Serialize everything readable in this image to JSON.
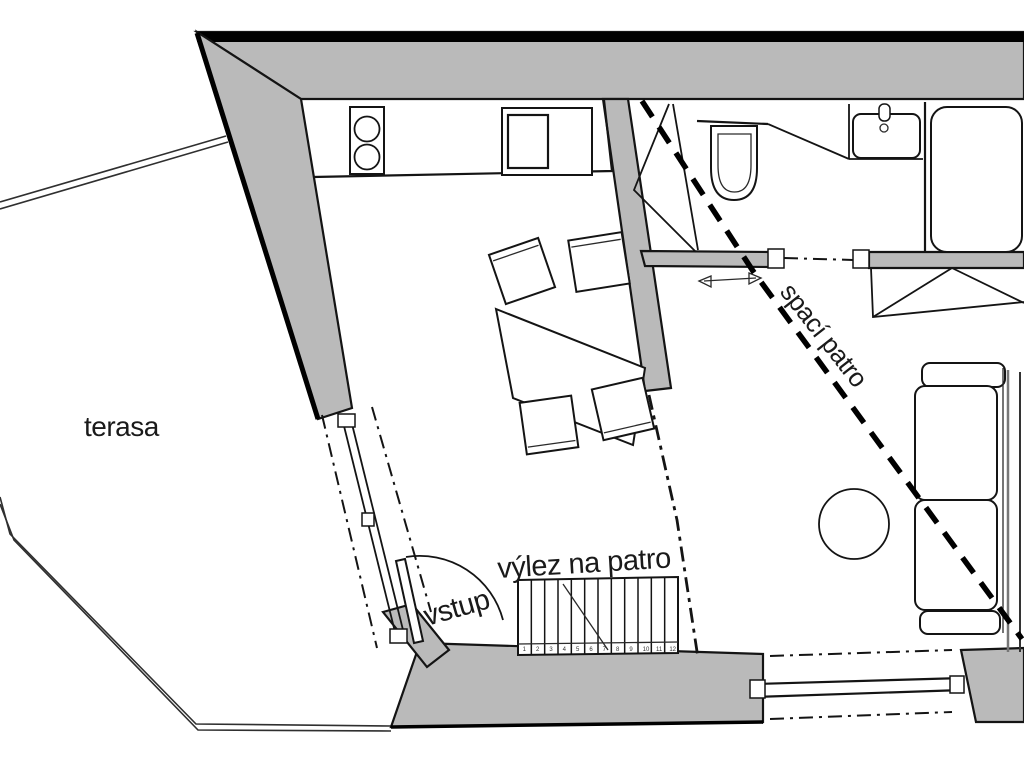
{
  "plan": {
    "type": "floor-plan",
    "labels": {
      "terrace": "terasa",
      "entrance": "vstup",
      "loft_hatch": "výlez na patro",
      "sleeping_loft": "spací patro"
    },
    "stairs": {
      "tread_count": 12,
      "step_numbers": [
        "1",
        "2",
        "3",
        "4",
        "5",
        "6",
        "7",
        "8",
        "9",
        "10",
        "11",
        "12"
      ]
    },
    "colors": {
      "wall_fill": "#bababa",
      "line": "#141414",
      "background": "#ffffff",
      "loft_dash": "#000000"
    },
    "fixtures": [
      "terrace",
      "glass-door",
      "entry-door",
      "stove",
      "kitchen-sink",
      "kitchen-counter",
      "dining-table",
      "chair",
      "divider-wall",
      "shower",
      "toilet",
      "washbasin",
      "faucet",
      "bathtub",
      "sliding-door",
      "wardrobe",
      "round-table",
      "sofa",
      "window",
      "stairs-ladder",
      "sleeping-loft-boundary"
    ]
  }
}
